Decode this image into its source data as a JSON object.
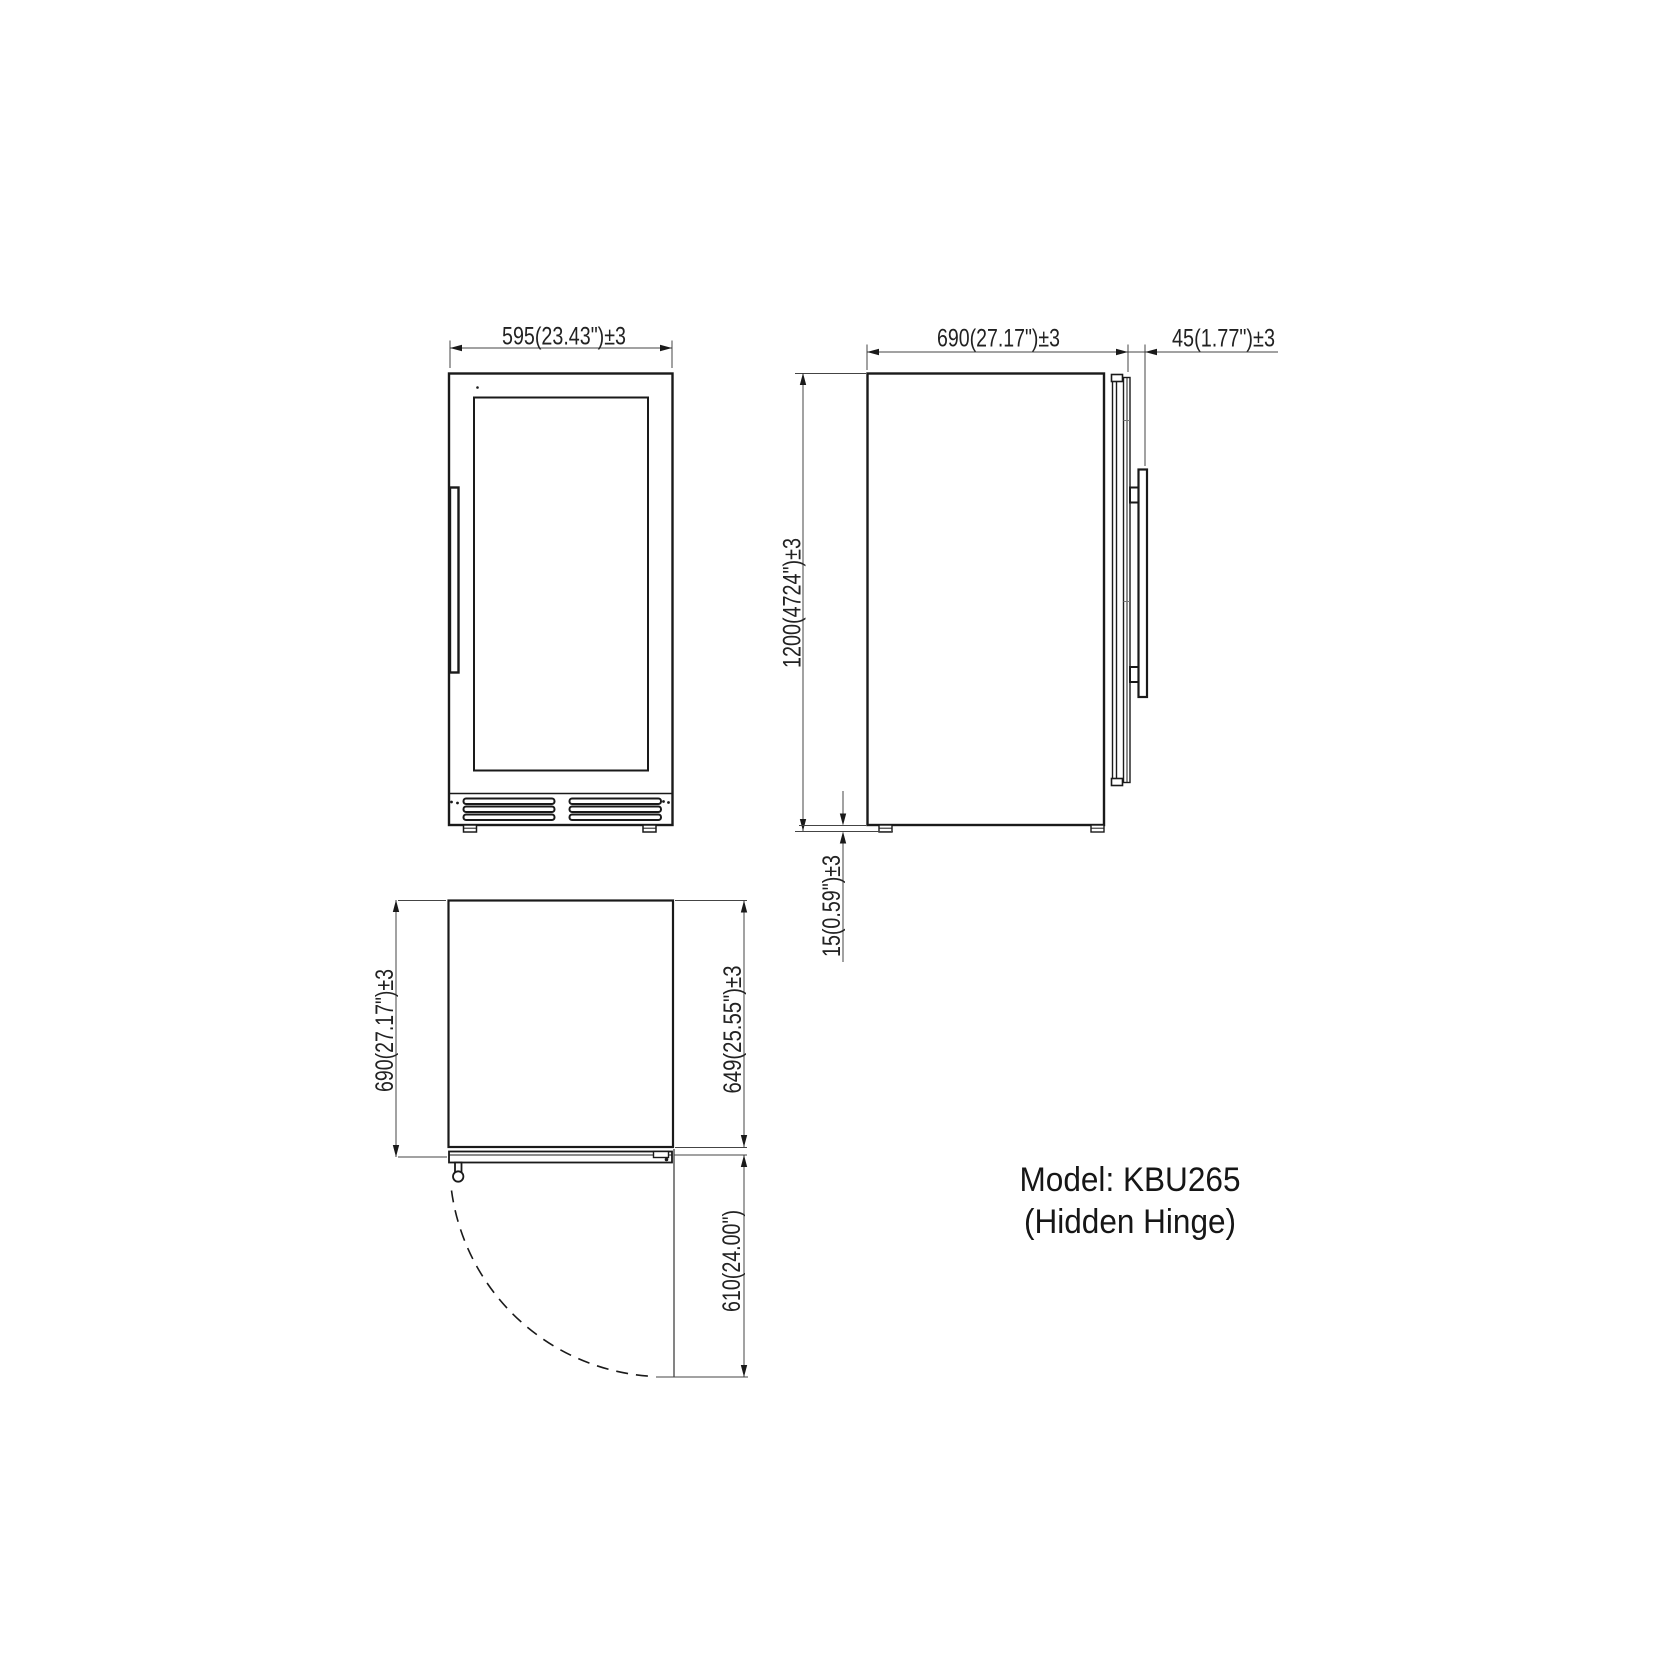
{
  "colors": {
    "background": "#ffffff",
    "line": "#1a1a1a",
    "dim_line": "#444444",
    "dim_text": "#222222",
    "model_text": "#161616"
  },
  "views": {
    "front_view": {
      "dimensions": {
        "width": "595(23.43\")±3"
      }
    },
    "side_view": {
      "dimensions": {
        "depth": "690(27.17\")±3",
        "door_handle": "45(1.77\")±3",
        "height": "1200(4724\")±3",
        "foot_height": "15(0.59\")±3"
      }
    },
    "top_view": {
      "dimensions": {
        "depth": "690(27.17\")±3",
        "body_depth": "649(25.55\")±3",
        "door_swing": "610(24.00\")"
      }
    }
  },
  "model_label": {
    "line1": "Model: KBU265",
    "line2": "(Hidden Hinge)"
  }
}
